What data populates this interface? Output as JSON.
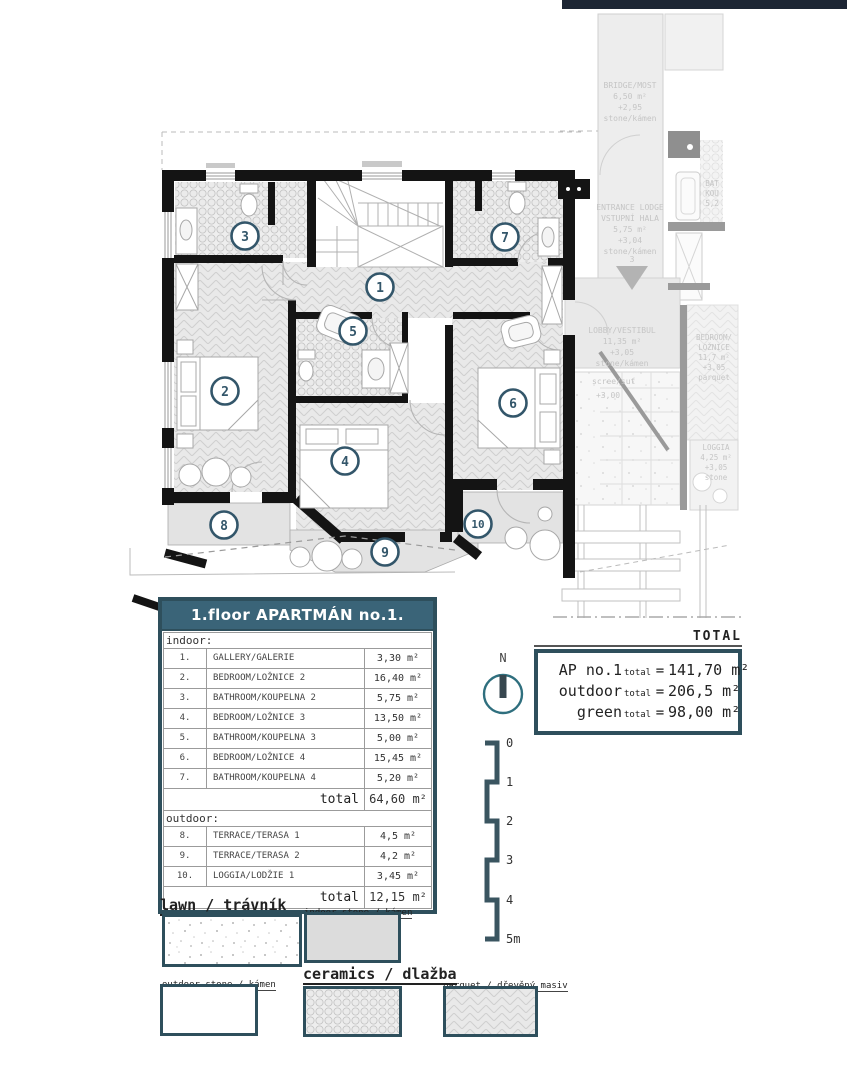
{
  "plan": {
    "rooms": [
      {
        "n": "1"
      },
      {
        "n": "2"
      },
      {
        "n": "3"
      },
      {
        "n": "4"
      },
      {
        "n": "5"
      },
      {
        "n": "6"
      },
      {
        "n": "7"
      },
      {
        "n": "8"
      },
      {
        "n": "9"
      },
      {
        "n": "10"
      }
    ],
    "context": {
      "bridge": [
        "BRIDGE/MOST",
        "6,50 m²",
        "+2,95",
        "stone/kámen"
      ],
      "entrance": [
        "ENTRANCE LODGE",
        "VSTUPNÍ HALA",
        "5,75 m²",
        "+3,04",
        "stone/kámen"
      ],
      "entrance_num": "3",
      "lobby": [
        "LOBBY/VESTIBUL",
        "11,35 m²",
        "+3,05",
        "stone/kámen"
      ],
      "scree": [
        "scree/suť",
        "+3,00"
      ],
      "bedroom": [
        "BEDROOM/",
        "LOŽNICE",
        "11,7 m²",
        "+3,05",
        "parquet"
      ],
      "loggia": [
        "LOGGIA",
        "4,25 m²",
        "+3,05",
        "stone"
      ],
      "bath": [
        "BAT",
        "KOU",
        "5,2"
      ]
    }
  },
  "table": {
    "title": "1.floor APARTMÁN no.1.",
    "indoor_label": "indoor:",
    "outdoor_label": "outdoor:",
    "total_label": "total",
    "indoor_rows": [
      {
        "num": "1.",
        "name": "GALLERY/GALERIE",
        "area": "3,30 m²"
      },
      {
        "num": "2.",
        "name": "BEDROOM/LOŽNICE 2",
        "area": "16,40 m²"
      },
      {
        "num": "3.",
        "name": "BATHROOM/KOUPELNA 2",
        "area": "5,75 m²"
      },
      {
        "num": "4.",
        "name": "BEDROOM/LOŽNICE 3",
        "area": "13,50 m²"
      },
      {
        "num": "5.",
        "name": "BATHROOM/KOUPELNA 3",
        "area": "5,00 m²"
      },
      {
        "num": "6.",
        "name": "BEDROOM/LOŽNICE 4",
        "area": "15,45 m²"
      },
      {
        "num": "7.",
        "name": "BATHROOM/KOUPELNA 4",
        "area": "5,20 m²"
      }
    ],
    "indoor_total": "64,60 m²",
    "outdoor_rows": [
      {
        "num": "8.",
        "name": "TERRACE/TERASA 1",
        "area": "4,5 m²"
      },
      {
        "num": "9.",
        "name": "TERRACE/TERASA 2",
        "area": "4,2 m²"
      },
      {
        "num": "10.",
        "name": "LOGGIA/LODŽIE 1",
        "area": "3,45 m²"
      }
    ],
    "outdoor_total": "12,15 m²"
  },
  "totals": {
    "heading": "TOTAL",
    "rows": [
      {
        "name": "AP no.1",
        "sub": "total",
        "eq": "=",
        "value": "141,70 m²"
      },
      {
        "name": "outdoor",
        "sub": "total",
        "eq": "=",
        "value": "206,5 m²"
      },
      {
        "name": "green",
        "sub": "total",
        "eq": "=",
        "value": "98,00 m²"
      }
    ]
  },
  "compass": {
    "north": "N"
  },
  "scalebar": {
    "ticks": [
      "0",
      "1",
      "2",
      "3",
      "4",
      "5m"
    ]
  },
  "legend": {
    "items": [
      {
        "label": "lawn / trávník"
      },
      {
        "label": "indoor stone / kámen"
      },
      {
        "label": "outdoor stone / kámen"
      },
      {
        "label": "ceramics / dlažba"
      },
      {
        "label": "parquet / dřevěný masiv"
      }
    ]
  },
  "colors": {
    "accent": "#2e4f5c",
    "header_bg": "#3a6478",
    "navy": "#1d2634"
  }
}
